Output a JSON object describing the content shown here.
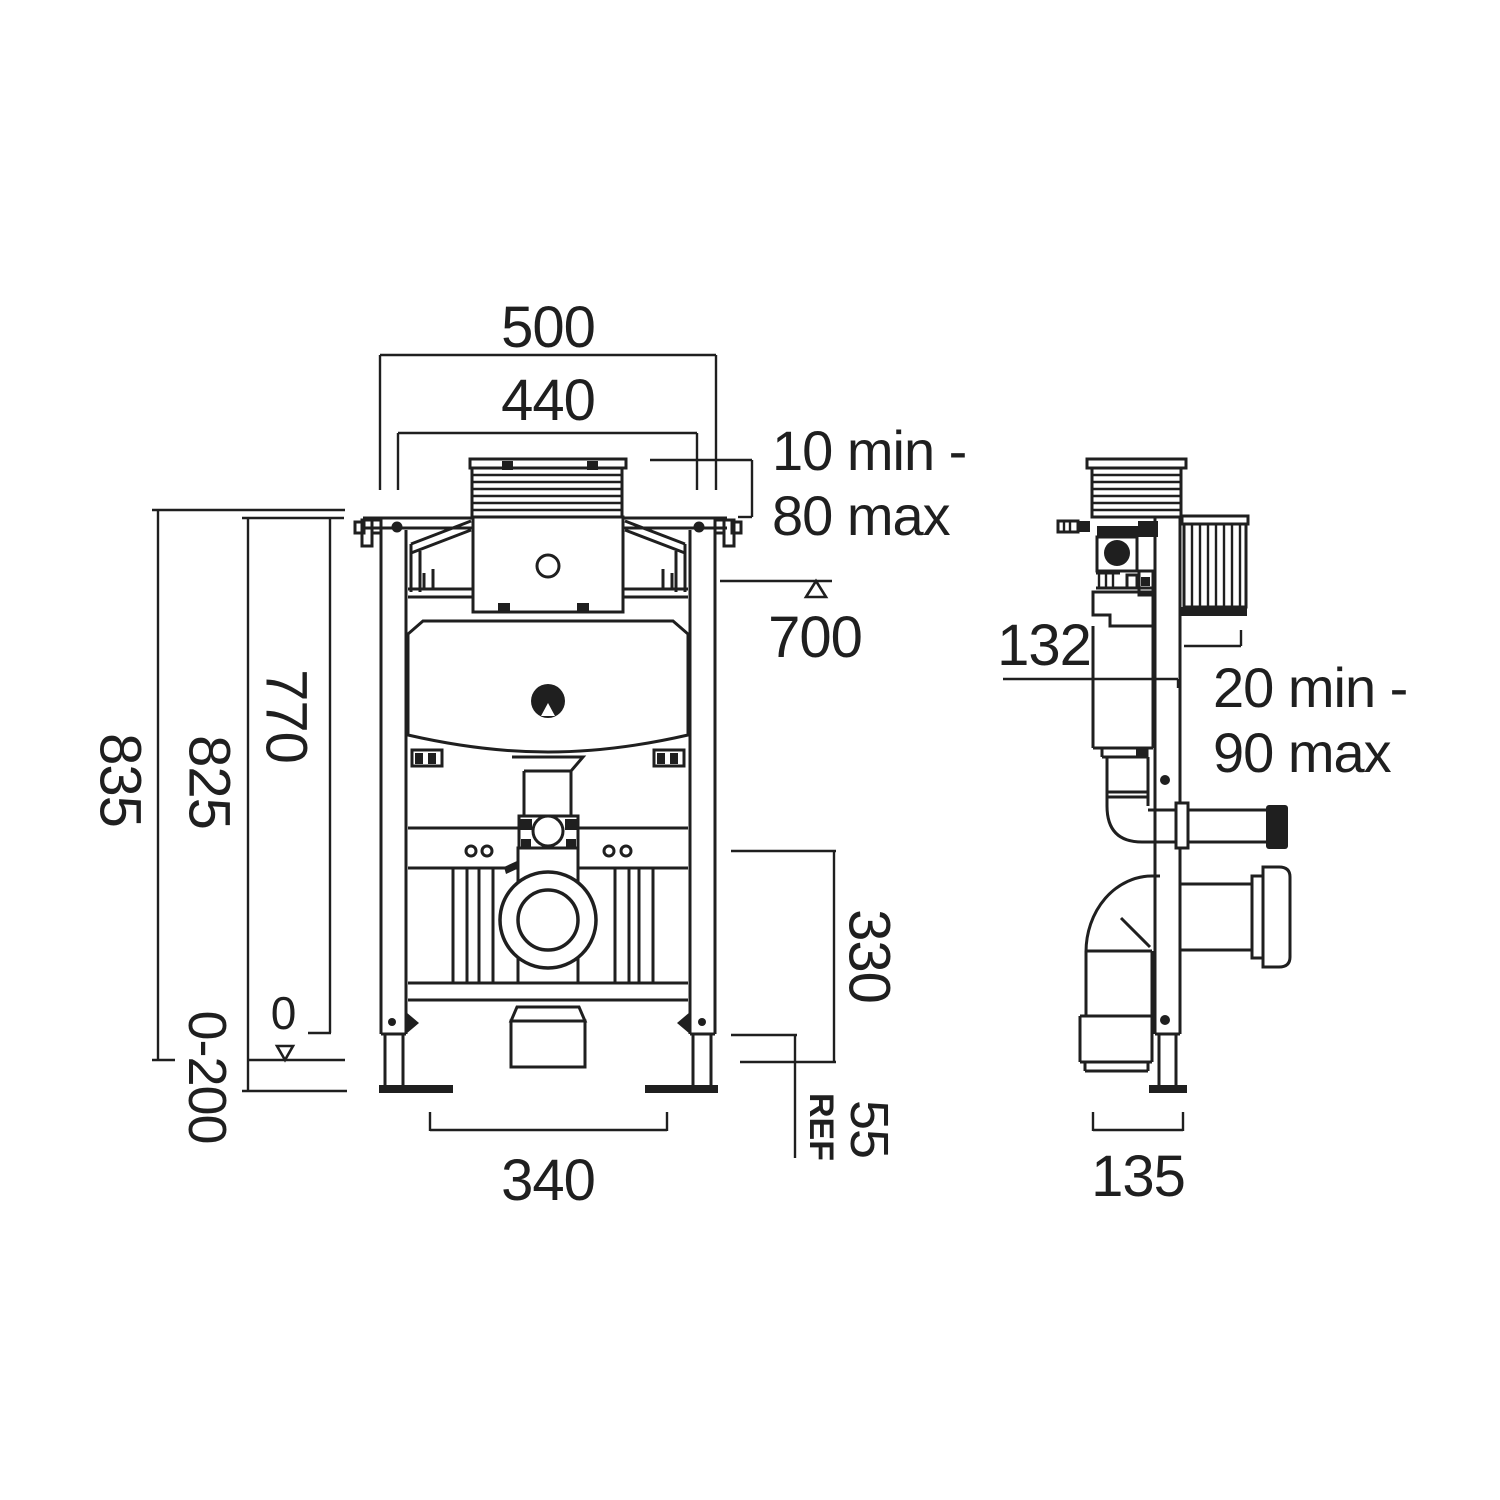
{
  "labels": {
    "front": {
      "width_outer": "500",
      "width_inner": "440",
      "plate_depth_line1": "10 min -",
      "plate_depth_line2": "80 max",
      "flush_center_height": "700",
      "height_overall": "835",
      "height_frame": "825",
      "height_inner": "770",
      "floor_zero": "0",
      "leg_adjustment": "0-200",
      "base_width": "340",
      "outlet_zone_height": "330",
      "ref_offset": "55",
      "ref": "REF"
    },
    "side": {
      "pipe_setback": "132",
      "finish_depth_line1": "20 min -",
      "finish_depth_line2": "90 max",
      "frame_depth": "135"
    }
  },
  "colors": {
    "line": "#1f1f1f",
    "background": "#ffffff"
  }
}
